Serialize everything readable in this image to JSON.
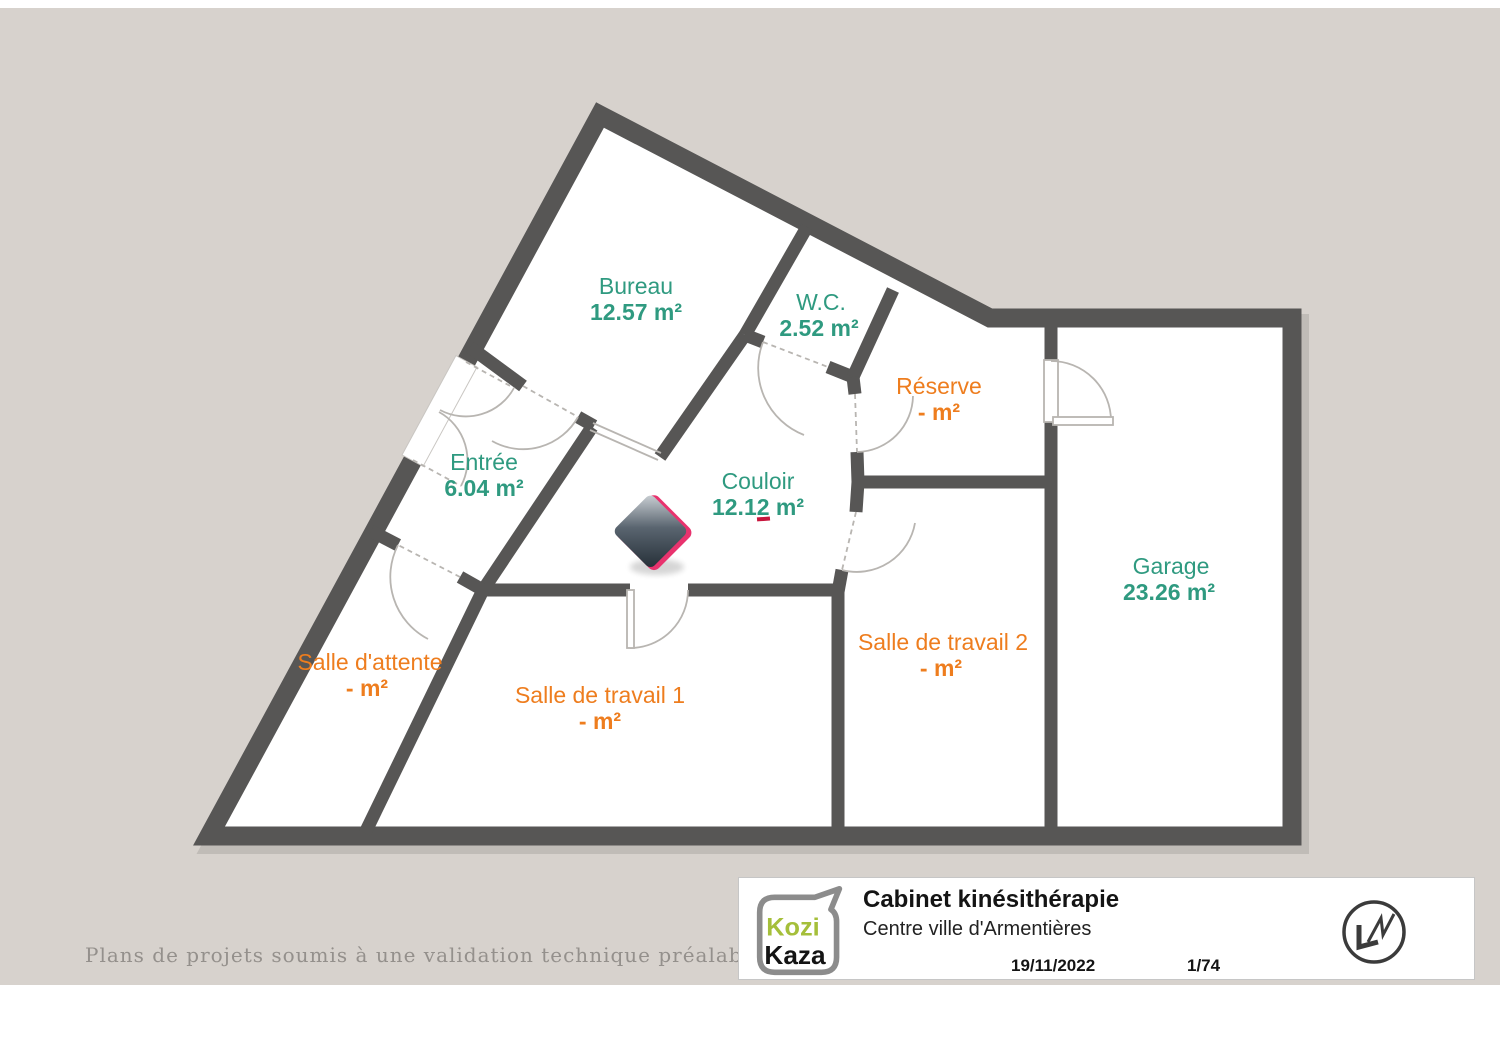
{
  "colors": {
    "page_background": "#d7d2cd",
    "paper_background": "#ffffff",
    "wall": "#575655",
    "door_lines": "#b8b5b1",
    "room_label_teal": "#2f9a80",
    "room_label_orange": "#ee7d1e",
    "logo_green": "#a5bf3a",
    "marker_pink": "#e8336e",
    "marker_dark": "#242e36"
  },
  "rooms": [
    {
      "name": "Bureau",
      "area": "12.57 m²"
    },
    {
      "name": "W.C.",
      "area": "2.52 m²"
    },
    {
      "name": "Réserve",
      "area": "- m²"
    },
    {
      "name": "Entrée",
      "area": "6.04 m²"
    },
    {
      "name": "Couloir",
      "area": "12.12 m²"
    },
    {
      "name": "Garage",
      "area": "23.26 m²"
    },
    {
      "name": "Salle d'attente",
      "area": "- m²"
    },
    {
      "name": "Salle de travail 1",
      "area": "- m²"
    },
    {
      "name": "Salle de travail 2",
      "area": "- m²"
    }
  ],
  "title_block": {
    "logo_line1": "Kozi",
    "logo_line2": "Kaza",
    "title": "Cabinet kinésithérapie",
    "subtitle": "Centre ville d'Armentières",
    "date": "19/11/2022",
    "page": "1/74"
  },
  "footer": {
    "disclaimer": "Plans de projets soumis à une validation technique préalable"
  }
}
